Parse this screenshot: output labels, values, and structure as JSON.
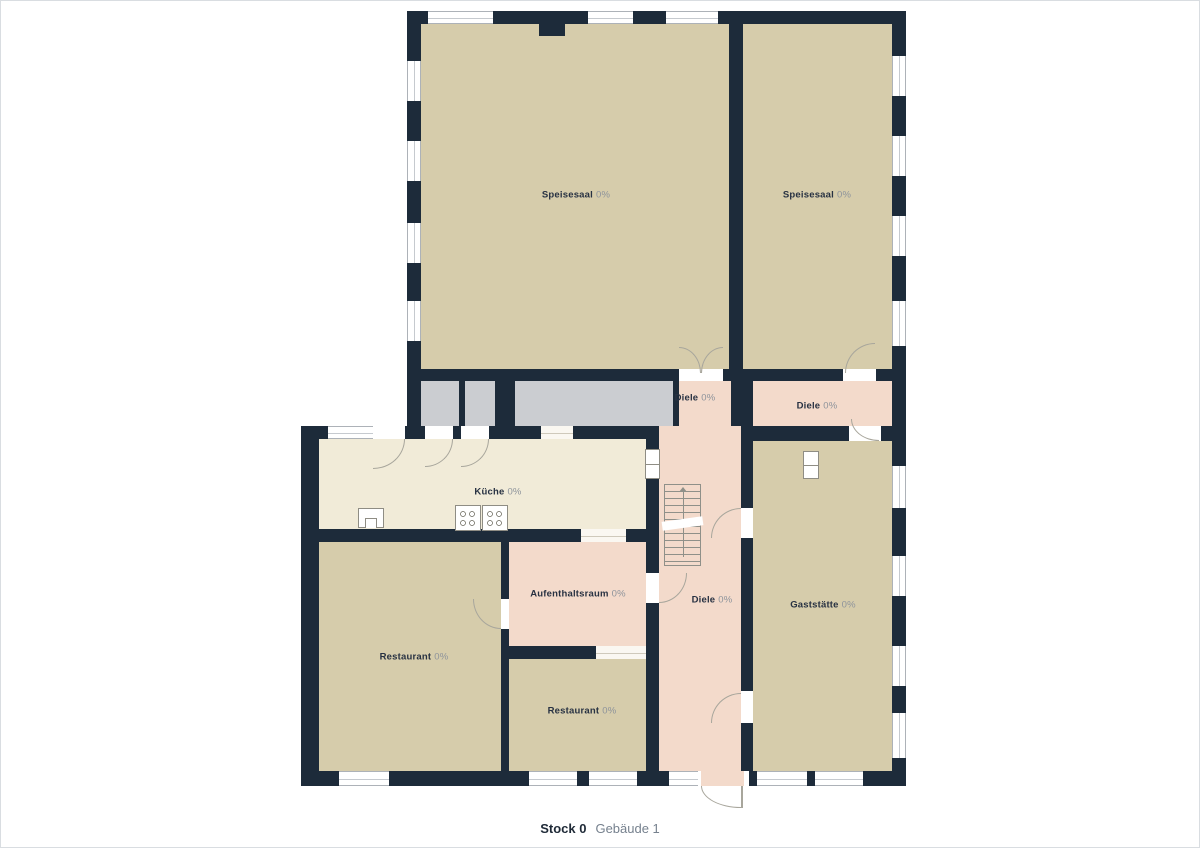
{
  "plan": {
    "caption": {
      "floor_label": "Stock 0",
      "building_label": "Gebäude 1"
    },
    "rooms": [
      {
        "id": "speisesaal-left",
        "name": "Speisesaal",
        "value": "0%"
      },
      {
        "id": "speisesaal-right",
        "name": "Speisesaal",
        "value": "0%"
      },
      {
        "id": "diele-top-left",
        "name": "Diele",
        "value": "0%"
      },
      {
        "id": "diele-top-right",
        "name": "Diele",
        "value": "0%"
      },
      {
        "id": "kueche",
        "name": "Küche",
        "value": "0%"
      },
      {
        "id": "aufenthaltsraum",
        "name": "Aufenthaltsraum",
        "value": "0%"
      },
      {
        "id": "diele-center",
        "name": "Diele",
        "value": "0%"
      },
      {
        "id": "gaststaette",
        "name": "Gaststätte",
        "value": "0%"
      },
      {
        "id": "restaurant-left",
        "name": "Restaurant",
        "value": "0%"
      },
      {
        "id": "restaurant-bottom",
        "name": "Restaurant",
        "value": "0%"
      }
    ],
    "colors": {
      "wall": "#1d2b3a",
      "room_beige": "#d6ccab",
      "room_pink": "#f3dacb",
      "room_cream": "#f1ebd8",
      "room_gray": "#cbcdd1",
      "label_text": "#273142",
      "label_pct": "#8d939b",
      "caption_floor": "#1f2a37",
      "caption_building": "#76818e"
    }
  }
}
